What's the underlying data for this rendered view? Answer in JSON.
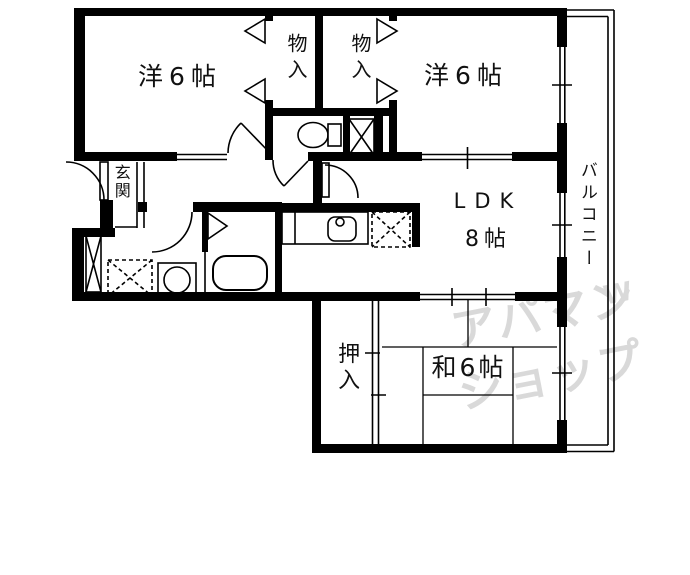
{
  "plan": {
    "rooms": [
      {
        "id": "bedroom-left",
        "label": "洋6帖"
      },
      {
        "id": "bedroom-right",
        "label": "洋6帖"
      },
      {
        "id": "closet-left",
        "label": "物入"
      },
      {
        "id": "closet-right",
        "label": "物入"
      },
      {
        "id": "entrance",
        "label": "玄関"
      },
      {
        "id": "ldk",
        "label": "LDK",
        "size_label": "8帖"
      },
      {
        "id": "oshiire",
        "label": "押入"
      },
      {
        "id": "japanese-room",
        "label": "和6帖"
      },
      {
        "id": "balcony",
        "label": "バルコニー"
      }
    ],
    "watermark": {
      "line1": "アパマン",
      "line2": "ショップ",
      "mark": "W",
      "color": "#d9d9d9"
    },
    "colors": {
      "line": "#000000",
      "background": "#ffffff"
    }
  }
}
